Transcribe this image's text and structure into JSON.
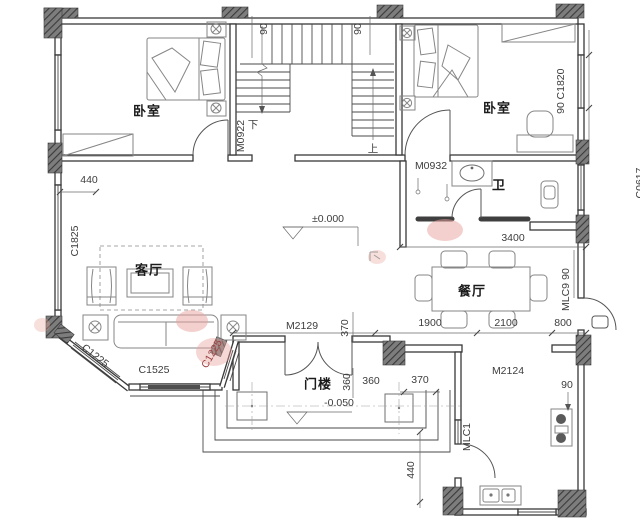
{
  "colors": {
    "wall_line": "#383838",
    "column_fill": "#787878",
    "red_label": "#9c4343",
    "watermark_pink": "#e7a29c"
  },
  "plan": {
    "rooms": {
      "bedroom_left": "卧室",
      "bedroom_right": "卧室",
      "bathroom": "卫",
      "living": "客厅",
      "dining": "餐厅",
      "gatehouse": "门楼"
    },
    "levels": {
      "main": "±0.000",
      "porch": "-0.050"
    },
    "stairs": {
      "up": "上",
      "down": "下",
      "dim_left": "90",
      "dim_right": "90"
    },
    "openings": {
      "m0922": "M0922",
      "m0932": "M0932",
      "m2129": "M2129",
      "m2124": "M2124",
      "mlc1": "MLC1",
      "mlc9": "MLC9",
      "c1825": "C1825",
      "c1225_left": "C1225",
      "c1525": "C1525",
      "c1225_right": "C1225",
      "c1820": "C1820",
      "c0617": "C0617"
    },
    "dims": {
      "d440_top": "440",
      "d3400": "3400",
      "d1900": "1900",
      "d2100": "2100",
      "d800": "800",
      "d90_bedroom": "90",
      "d90_dining": "90",
      "d90_kitchen": "90",
      "d370_center": "370",
      "d370_bottom": "370",
      "d360_a": "360",
      "d360_b": "360",
      "d440_bottom": "440"
    }
  }
}
